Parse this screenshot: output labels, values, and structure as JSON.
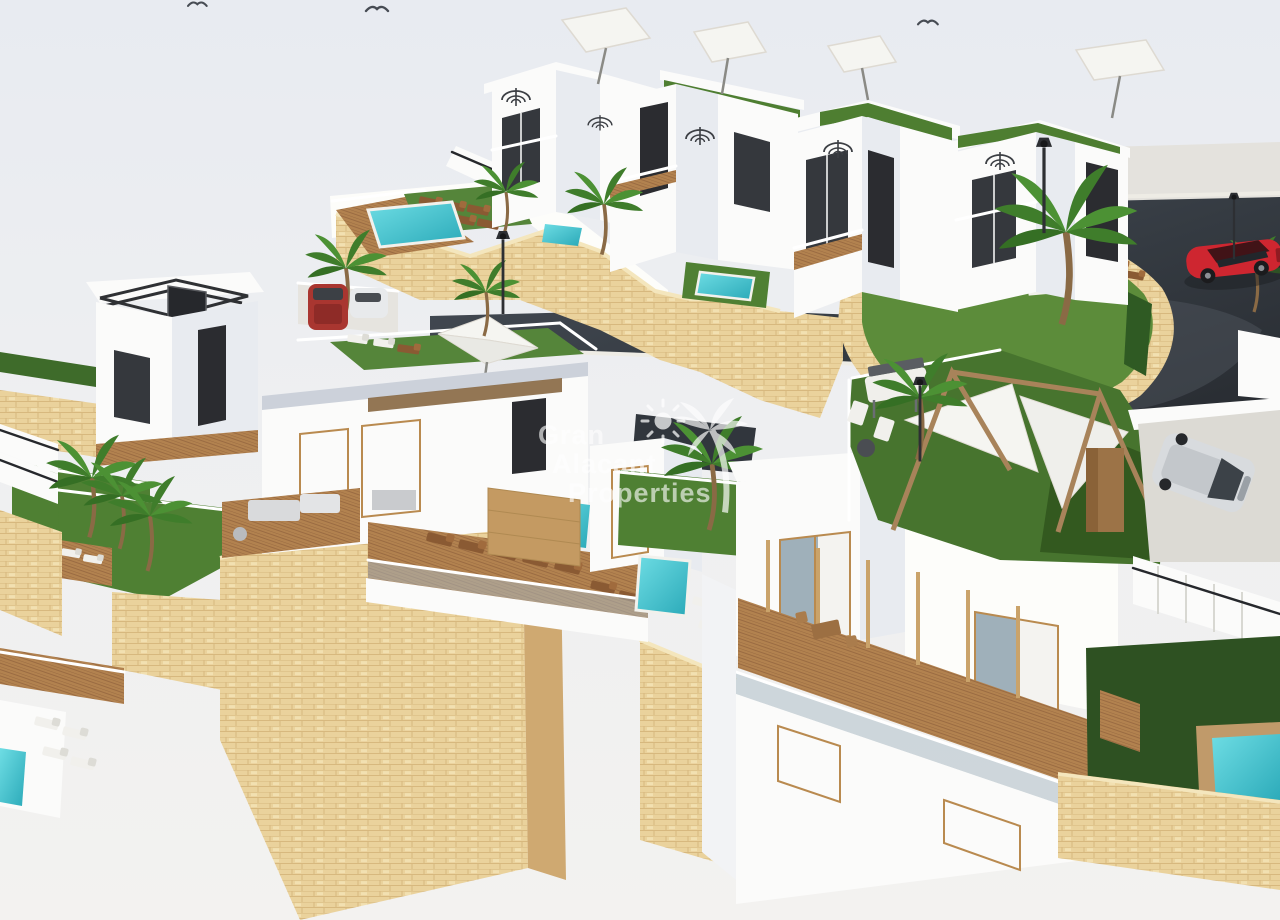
{
  "image": {
    "type": "3d-architectural-render",
    "subject": "Aerial 3D render of a hillside development of white villas with private pools, roof terraces, palm trees, sandstone retaining walls and a curved asphalt access road",
    "watermark": {
      "line1": "Gran",
      "line2": "Alacant",
      "line3": "Properties",
      "icons": [
        "sun-icon",
        "palm-tree-icon"
      ],
      "color": "#ffffff"
    },
    "colors": {
      "sky": "#e8ebf1",
      "ground": "#f3f2f0",
      "road": "#353b42",
      "sidewalk": "#e4e2dd",
      "stone_wall": "#ead29c",
      "stone_wall_shaded": "#cfa971",
      "grass_sunlit": "#55853a",
      "grass_shaded": "#2e5122",
      "pool_water": "#3fc4cf",
      "building_white": "#fbfbfa",
      "building_side": "#e8ebf0",
      "window_dark": "#35383d",
      "wood_deck": "#b2824f",
      "red_car": "#ce2630",
      "parked_suv_red": "#a93630",
      "silver_car": "#d8dbde",
      "umbrella": "#f5f5f1"
    },
    "objects": [
      "back-row-townhouses",
      "left-villa",
      "center-villa",
      "front-villa",
      "roof-terraces",
      "spiral-staircases",
      "white-umbrellas",
      "swimming-pools",
      "sun-loungers",
      "palm-trees",
      "stone-retaining-walls",
      "access-road",
      "sidewalk",
      "street-lamps",
      "red-sports-car",
      "parked-cars",
      "silver-car",
      "pergola-garden",
      "barbecue",
      "outdoor-staircases",
      "seagulls"
    ]
  }
}
